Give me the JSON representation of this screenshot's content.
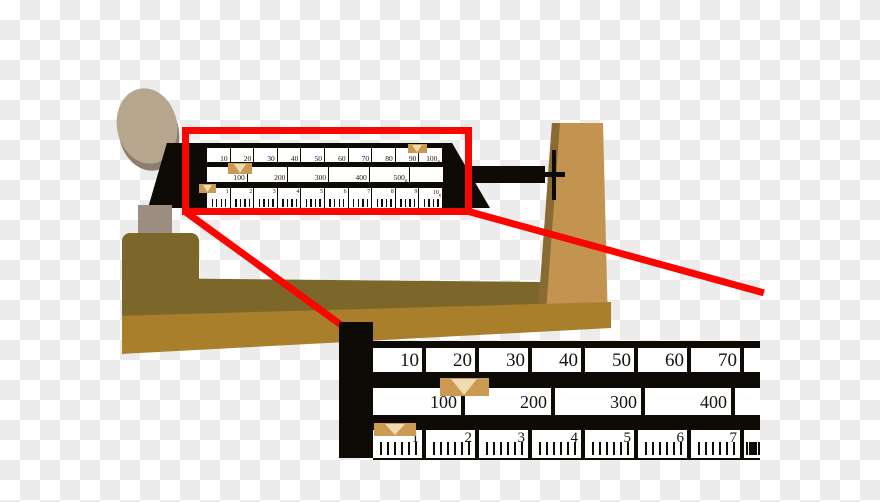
{
  "colors": {
    "checker_gray": "#ececec",
    "black": "#0e0b06",
    "red": "#fa0600",
    "rider_tan": "#cb9a52",
    "rider_cream": "#eddbb4",
    "pan": "#b5a68d",
    "pan_rim": "#8c7d6e",
    "pedestal": "#9c8e81",
    "pillar": "#c39350",
    "pillar_shadow": "#8a6a33",
    "base_dark": "#7b672a",
    "base_gold": "#a97f2c",
    "text": "#151310"
  },
  "small_view": {
    "top_beam": {
      "labels": [
        "10",
        "20",
        "30",
        "40",
        "50",
        "60",
        "70",
        "80",
        "90",
        "100"
      ],
      "unit": "g"
    },
    "middle_beam": {
      "labels": [
        "100",
        "200",
        "300",
        "400",
        "500"
      ],
      "unit": "g"
    },
    "bottom_beam": {
      "labels": [
        "1",
        "2",
        "3",
        "4",
        "5",
        "6",
        "7",
        "8",
        "9",
        "10"
      ],
      "unit": "g"
    }
  },
  "magnified_view": {
    "top_beam": {
      "labels": [
        "10",
        "20",
        "30",
        "40",
        "50",
        "60",
        "70"
      ]
    },
    "middle_beam": {
      "labels": [
        "100",
        "200",
        "300",
        "400"
      ]
    },
    "bottom_beam": {
      "labels": [
        "1",
        "2",
        "3",
        "4",
        "5",
        "6",
        "7"
      ]
    }
  }
}
